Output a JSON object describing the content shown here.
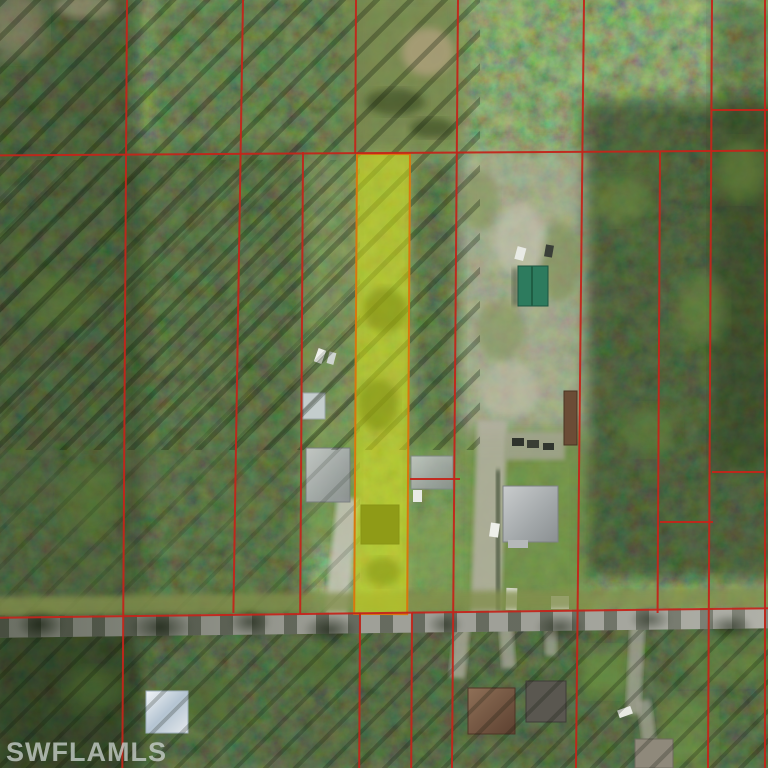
{
  "watermark": {
    "text": "SWFLAMLS"
  },
  "map": {
    "kind": "aerial parcel map (MLS listing view)",
    "highlighted_parcel": {
      "description": "long narrow lot in center, shaded yellow, running from north boundary line south to the road",
      "fill": "#d8e410",
      "border": "#d8770e"
    },
    "road": {
      "description": "east-west paved road near bottom of image",
      "color": "#9fa098"
    },
    "colors": {
      "boundary_line": "#c3251a",
      "forest_dark": "#24330f",
      "forest_light": "#5c7a35",
      "clearing_gravel": "#b2ae9d",
      "lawn": "#6d8d41",
      "watermark": "#cdd4d2"
    },
    "features": [
      "red parcel boundary grid dividing long narrow wooded lots",
      "green metal-roof barn on gravel clearing right of highlighted lot",
      "gray-roof houses with white driveways flanking highlighted lot",
      "white-roof building below road at lower left",
      "houses with brown and gray roofs along south side of road",
      "grass clearing with dirt patch at top center"
    ]
  }
}
